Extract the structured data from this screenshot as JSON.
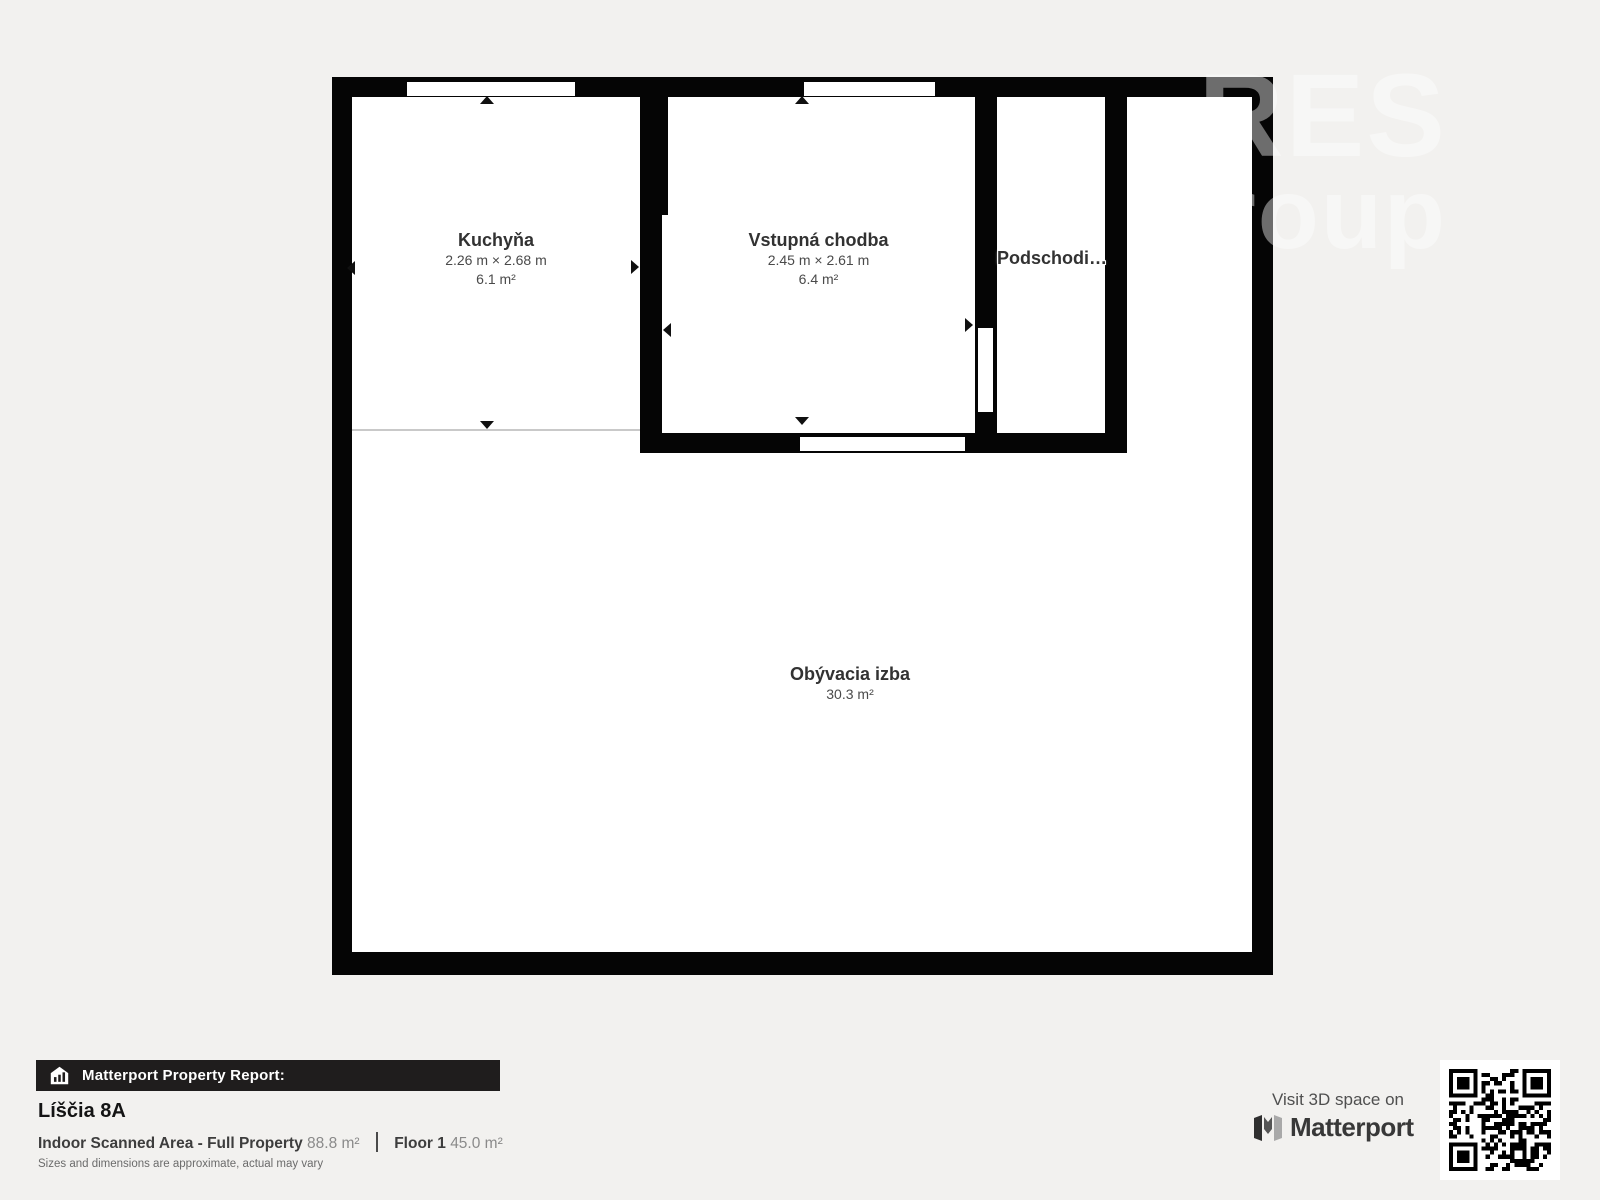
{
  "watermark": {
    "line1": "RES",
    "line2": "group"
  },
  "floor_plan": {
    "rooms": [
      {
        "id": "kuchyna",
        "name": "Kuchyňa",
        "dimensions": "2.26 m × 2.68 m",
        "area": "6.1 m²"
      },
      {
        "id": "vstupna",
        "name": "Vstupná chodba",
        "dimensions": "2.45 m × 2.61 m",
        "area": "6.4 m²"
      },
      {
        "id": "podschodie",
        "name": "Podschodi…"
      },
      {
        "id": "obyvacia",
        "name": "Obývacia izba",
        "area": "30.3 m²"
      }
    ]
  },
  "report": {
    "banner": "Matterport Property Report:",
    "property_name": "Líščia 8A",
    "scanned_area_label": "Indoor Scanned Area - Full Property",
    "scanned_area_value": "88.8 m²",
    "floor_label": "Floor 1",
    "floor_value": "45.0 m²",
    "disclaimer": "Sizes and dimensions are approximate, actual may vary"
  },
  "visit": {
    "text": "Visit 3D space on",
    "brand": "Matterport"
  },
  "colors": {
    "page_background": "#f2f1ef",
    "wall": "#050505",
    "room_fill": "#ffffff",
    "banner_background": "#1f1d1d",
    "banner_text": "#ffffff",
    "label_text": "#323232",
    "muted_text": "#8a8a8a"
  }
}
